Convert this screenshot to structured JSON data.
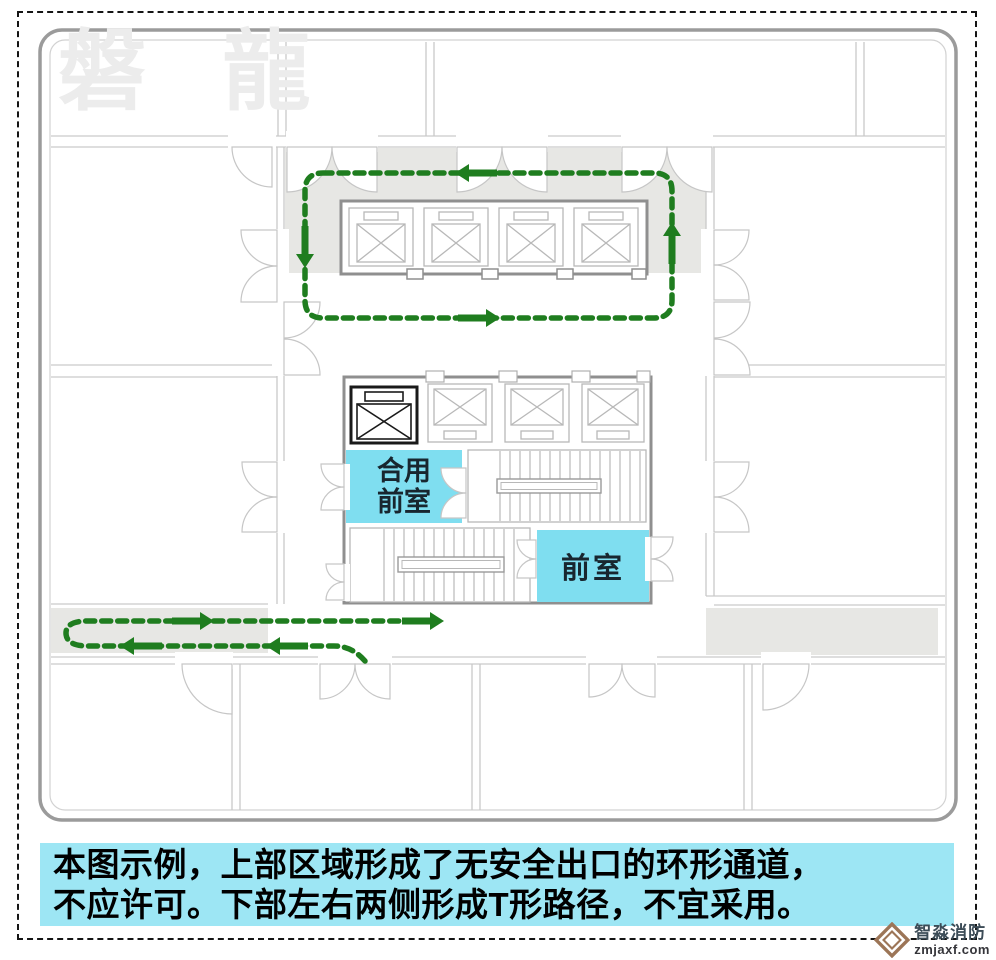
{
  "colors": {
    "path_green": "#1f7d1f",
    "corridor_gray": "#e7e7e4",
    "label_cyan": "#7fdef0",
    "caption_cyan": "#9de6f4",
    "wall_light": "#c9c9c9",
    "wall_dark": "#8f8f8f"
  },
  "watermark": {
    "text": "磐 龍"
  },
  "plan": {
    "labels": {
      "shared_lobby_line1": "合用",
      "shared_lobby_line2": "前室",
      "lobby": "前室"
    }
  },
  "caption": {
    "line1": "本图示例，上部区域形成了无安全出口的环形通道，",
    "line2": "不应许可。下部左右两侧形成T形路径，不宜采用。"
  },
  "logo": {
    "brand": "智淼消防",
    "domain": "zmjaxf.com"
  }
}
